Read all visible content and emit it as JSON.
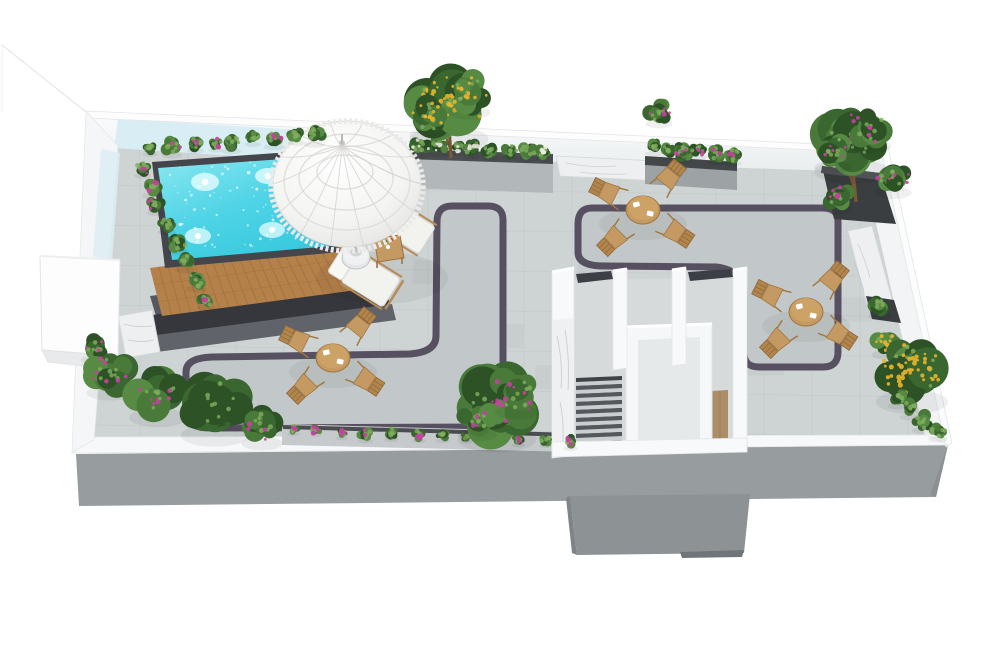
{
  "scene": {
    "title": "3D rooftop terrace floor plan rendering",
    "type": "isometric architectural visualization",
    "background": "#ffffff"
  },
  "palette": {
    "pavement": "#ced3d4",
    "pavement_inner": "#c2c8c9",
    "path_border": "#575061",
    "wall_white": "#f6f8f9",
    "wall_face": "#eef1f2",
    "pool_wall_blue": "#d9edf4",
    "facade_gray": "#979c9f",
    "shaft_gray": "#8d9295",
    "pool_water_light": "#8ae8f0",
    "pool_water_deep": "#39c9de",
    "pool_coping": "#44464b",
    "deck_wood": "#b5814b",
    "deck_wood_joint": "#8f6434",
    "platform_dark": "#3a3c41",
    "platform_step": "#60646a",
    "furniture_wood": "#c49a62",
    "furniture_wood_dark": "#a0763f",
    "cushion_white": "#f2f2ef",
    "umbrella_white": "#fbfbfa",
    "umbrella_shade": "#e6e6e4",
    "marble": "#edeff0",
    "marble_vein": "#b9bec2",
    "planter_stone": "#b2b7b9",
    "planter_dark": "#3a3e41",
    "soil_dark": "#4a4e50",
    "stair_tread": "#caced0",
    "stair_riser": "#54585c",
    "landing_wood": "#ab8d68",
    "greens": [
      "#4a7a39",
      "#3a6630",
      "#2d5226",
      "#578b43"
    ],
    "green_highlight": "#7fae5e",
    "trunk": "#7a5a35",
    "flower_pink": "#c73fa0",
    "flower_yellow": "#e9b42b",
    "flower_white": "#eff1e6",
    "door_dark": "#3c4046"
  },
  "inventory": {
    "pool": {
      "label": "swimming pool with underwater lights",
      "count": 1
    },
    "pool_deck": {
      "label": "raised timber pool deck with steps",
      "count": 1
    },
    "parasol": {
      "label": "white fringed parasol",
      "count": 1
    },
    "sun_loungers": {
      "label": "cushioned sun loungers",
      "count": 2
    },
    "side_table": {
      "label": "timber side table",
      "count": 1
    },
    "dining_sets": {
      "label": "round timber dining table with four folding chairs",
      "count": 3
    },
    "stairwell": {
      "label": "rooftop stair enclosure",
      "count": 1
    },
    "walkway_loops": {
      "label": "dark-bordered paving lanes",
      "count": 2
    },
    "planters": {
      "label": "planter boxes, hedges and benches",
      "count": 10
    },
    "flowering_trees": {
      "label": "flowering trees (yellow and pink)",
      "count": 3
    }
  }
}
